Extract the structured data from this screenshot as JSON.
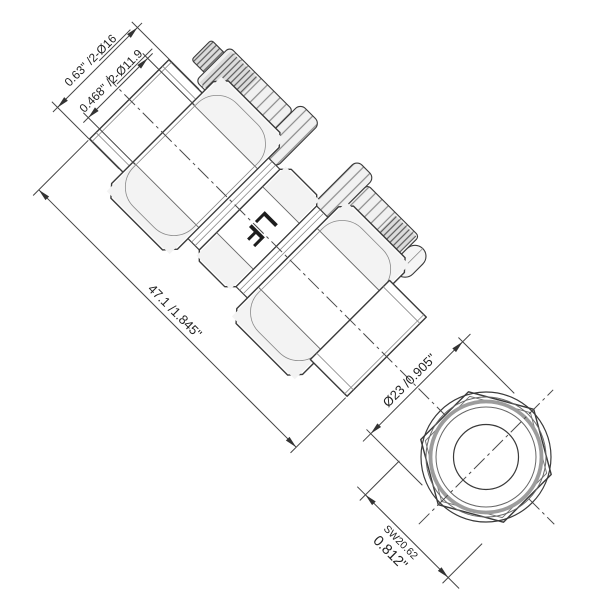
{
  "drawing": {
    "title": "compression-coupling-technical-drawing",
    "marking": "LF",
    "dimensions": {
      "stub_outer_diameter": "0.63\" /2-Ø16",
      "stub_inner_diameter": "0.468\" /2-Ø11.9",
      "overall_length": "47.1 /1.845\"",
      "end_view_diameter": "Ø23 /0.905\"",
      "wrench_size_metric": "SW20.62",
      "wrench_size_inch": "0.812\""
    },
    "colors": {
      "background": "#ffffff",
      "line": "#3a3a3a",
      "dimension_line": "#444444",
      "hatch": "#8a8a8a",
      "thick_ring": "#9c9c9c",
      "text": "#222222"
    }
  }
}
